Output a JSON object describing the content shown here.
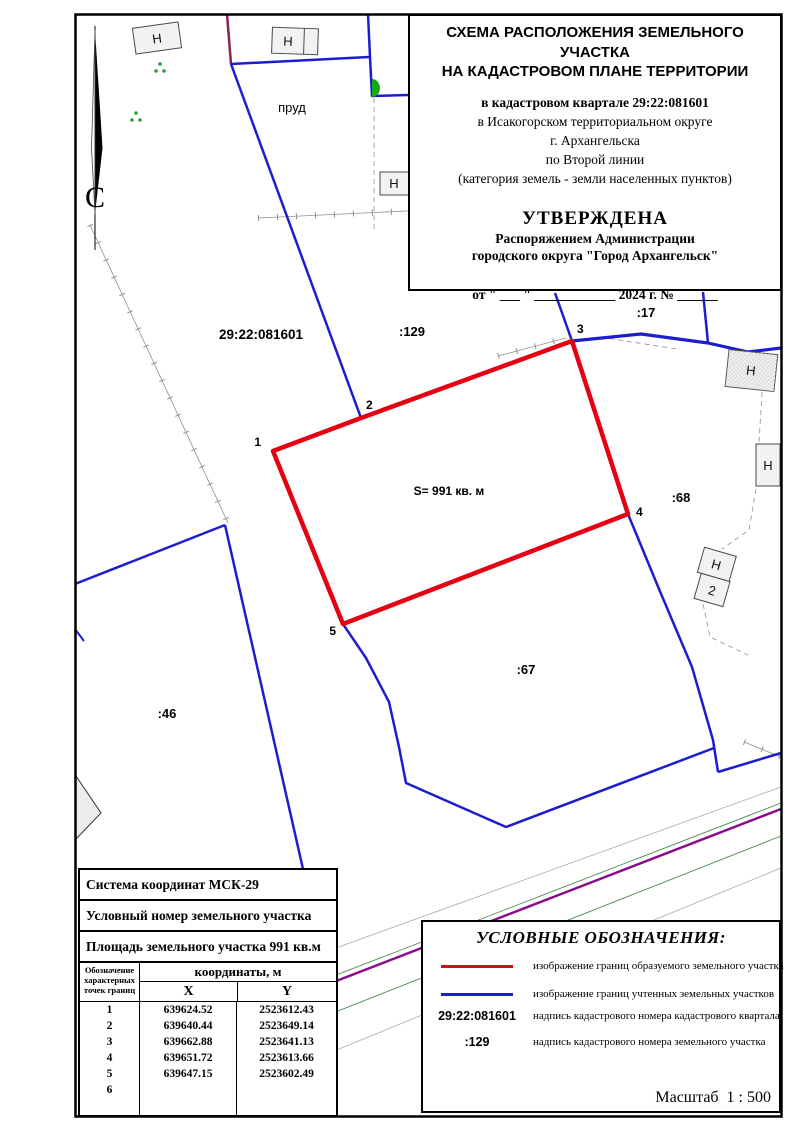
{
  "colors": {
    "formed_boundary": "#e60012",
    "registered_boundary": "#1d1dcf",
    "road": "#8c0a8c"
  },
  "title_block": {
    "line1": "СХЕМА РАСПОЛОЖЕНИЯ ЗЕМЕЛЬНОГО УЧАСТКА",
    "line2": "НА КАДАСТРОВОМ ПЛАНЕ ТЕРРИТОРИИ",
    "quarter": "в кадастровом квартале 29:22:081601",
    "district": "в Исакогорском территориальном округе",
    "city": "г. Архангельска",
    "street": "по Второй линии",
    "category": "(категория земель - земли населенных пунктов)",
    "approved": "УТВЕРЖДЕНА",
    "approved_by1": "Распоряжением Администрации",
    "approved_by2": "городского округа \"Город Архангельск\"",
    "date_line": "от \" ___ \" ____________ 2024 г. № ______"
  },
  "map": {
    "labels": {
      "north": "С",
      "cadastral_quarter": "29:22:081601",
      "pond": "пруд",
      "parcel_129": ":129",
      "parcel_17": ":17",
      "parcel_68": ":68",
      "parcel_67": ":67",
      "parcel_46": ":46",
      "area": "S= 991 кв. м",
      "building": "Н",
      "building2": "2"
    },
    "points": {
      "p1": "1",
      "p2": "2",
      "p3": "3",
      "p4": "4",
      "p5": "5"
    }
  },
  "table": {
    "coord_system": "Система координат МСК-29",
    "conditional_number": "Условный номер земельного участка",
    "area": "Площадь земельного участка 991 кв.м",
    "points_header": "Обозначение характерных точек границ",
    "coords_header": "координаты, м",
    "x": "X",
    "y": "Y",
    "rows": [
      {
        "n": "1",
        "x": "639624.52",
        "y": "2523612.43"
      },
      {
        "n": "2",
        "x": "639640.44",
        "y": "2523649.14"
      },
      {
        "n": "3",
        "x": "639662.88",
        "y": "2523641.13"
      },
      {
        "n": "4",
        "x": "639651.72",
        "y": "2523613.66"
      },
      {
        "n": "5",
        "x": "639647.15",
        "y": "2523602.49"
      },
      {
        "n": "6",
        "x": "",
        "y": ""
      }
    ]
  },
  "legend": {
    "title": "УСЛОВНЫЕ ОБОЗНАЧЕНИЯ:",
    "items": [
      {
        "symbol": "red-line",
        "label": "изображение границ образуемого земельного участка"
      },
      {
        "symbol": "blue-line",
        "label": "изображение границ учтенных земельных участков"
      },
      {
        "symbol": "29:22:081601",
        "label": "надпись кадастрового номера кадастрового квартала"
      },
      {
        "symbol": ":129",
        "label": "надпись кадастрового номера земельного участка"
      }
    ],
    "scale": "Масштаб  1 : 500"
  }
}
